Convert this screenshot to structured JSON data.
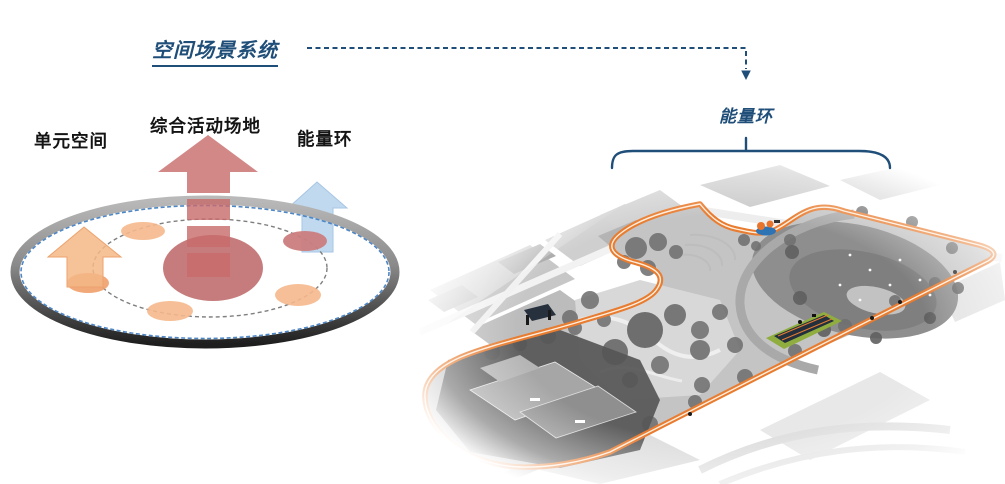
{
  "slide": {
    "title": "空间场景系统",
    "labels": {
      "unit_space": "单元空间",
      "activity_ground": "综合活动场地",
      "energy_ring": "能量环"
    },
    "map": {
      "label": "能量环"
    },
    "colors": {
      "navy": "#1f4e79",
      "ring_orange": "#e87c30",
      "ring_orange_center": "#fdeede",
      "track_green": "#8fae3f",
      "pavilion_blue": "#2e74b5",
      "pavilion_orange": "#e8742c",
      "center_red": "#c17171",
      "arrow_red": "#c86a6a",
      "arrow_orange": "#f4b786",
      "arrow_blue": "#bdd7ee",
      "node_orange": "#f5b88c",
      "node_red": "#cb7d7d",
      "dash_blue": "#4f87c5",
      "label_black": "#141414"
    }
  }
}
